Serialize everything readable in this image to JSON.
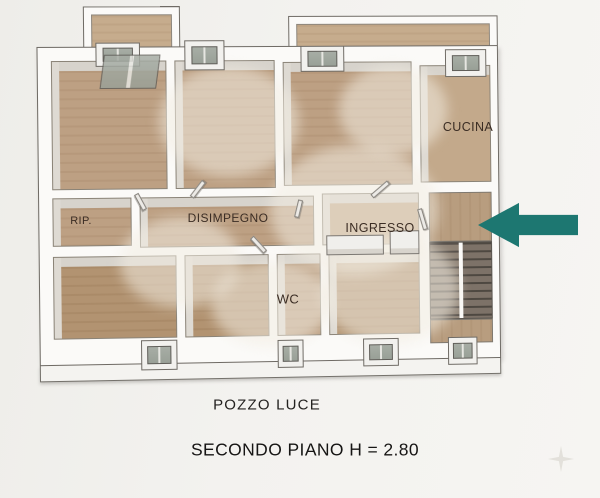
{
  "plan": {
    "rooms": [
      {
        "id": "rip",
        "label": "RIP."
      },
      {
        "id": "disimpegno",
        "label": "DISIMPEGNO"
      },
      {
        "id": "ingresso",
        "label": "INGRESSO"
      },
      {
        "id": "cucina",
        "label": "CUCINA"
      },
      {
        "id": "wc",
        "label": "WC"
      }
    ],
    "captions": {
      "light_well": "POZZO LUCE",
      "floor_title": "SECONDO PIANO H = 2.80"
    },
    "annotations": {
      "entrance_arrow_direction": "left"
    },
    "colors": {
      "arrow": "#1d7771",
      "floor_wood": "#bda083",
      "floor_wood_dark": "#b29371",
      "wall_white": "#fbfaf8",
      "wall_outline": "#6f6b65",
      "stair_tread_dark": "#57504a",
      "label_text": "#3b2d24",
      "caption_text": "#161514",
      "background": "#f2f1ee"
    }
  }
}
